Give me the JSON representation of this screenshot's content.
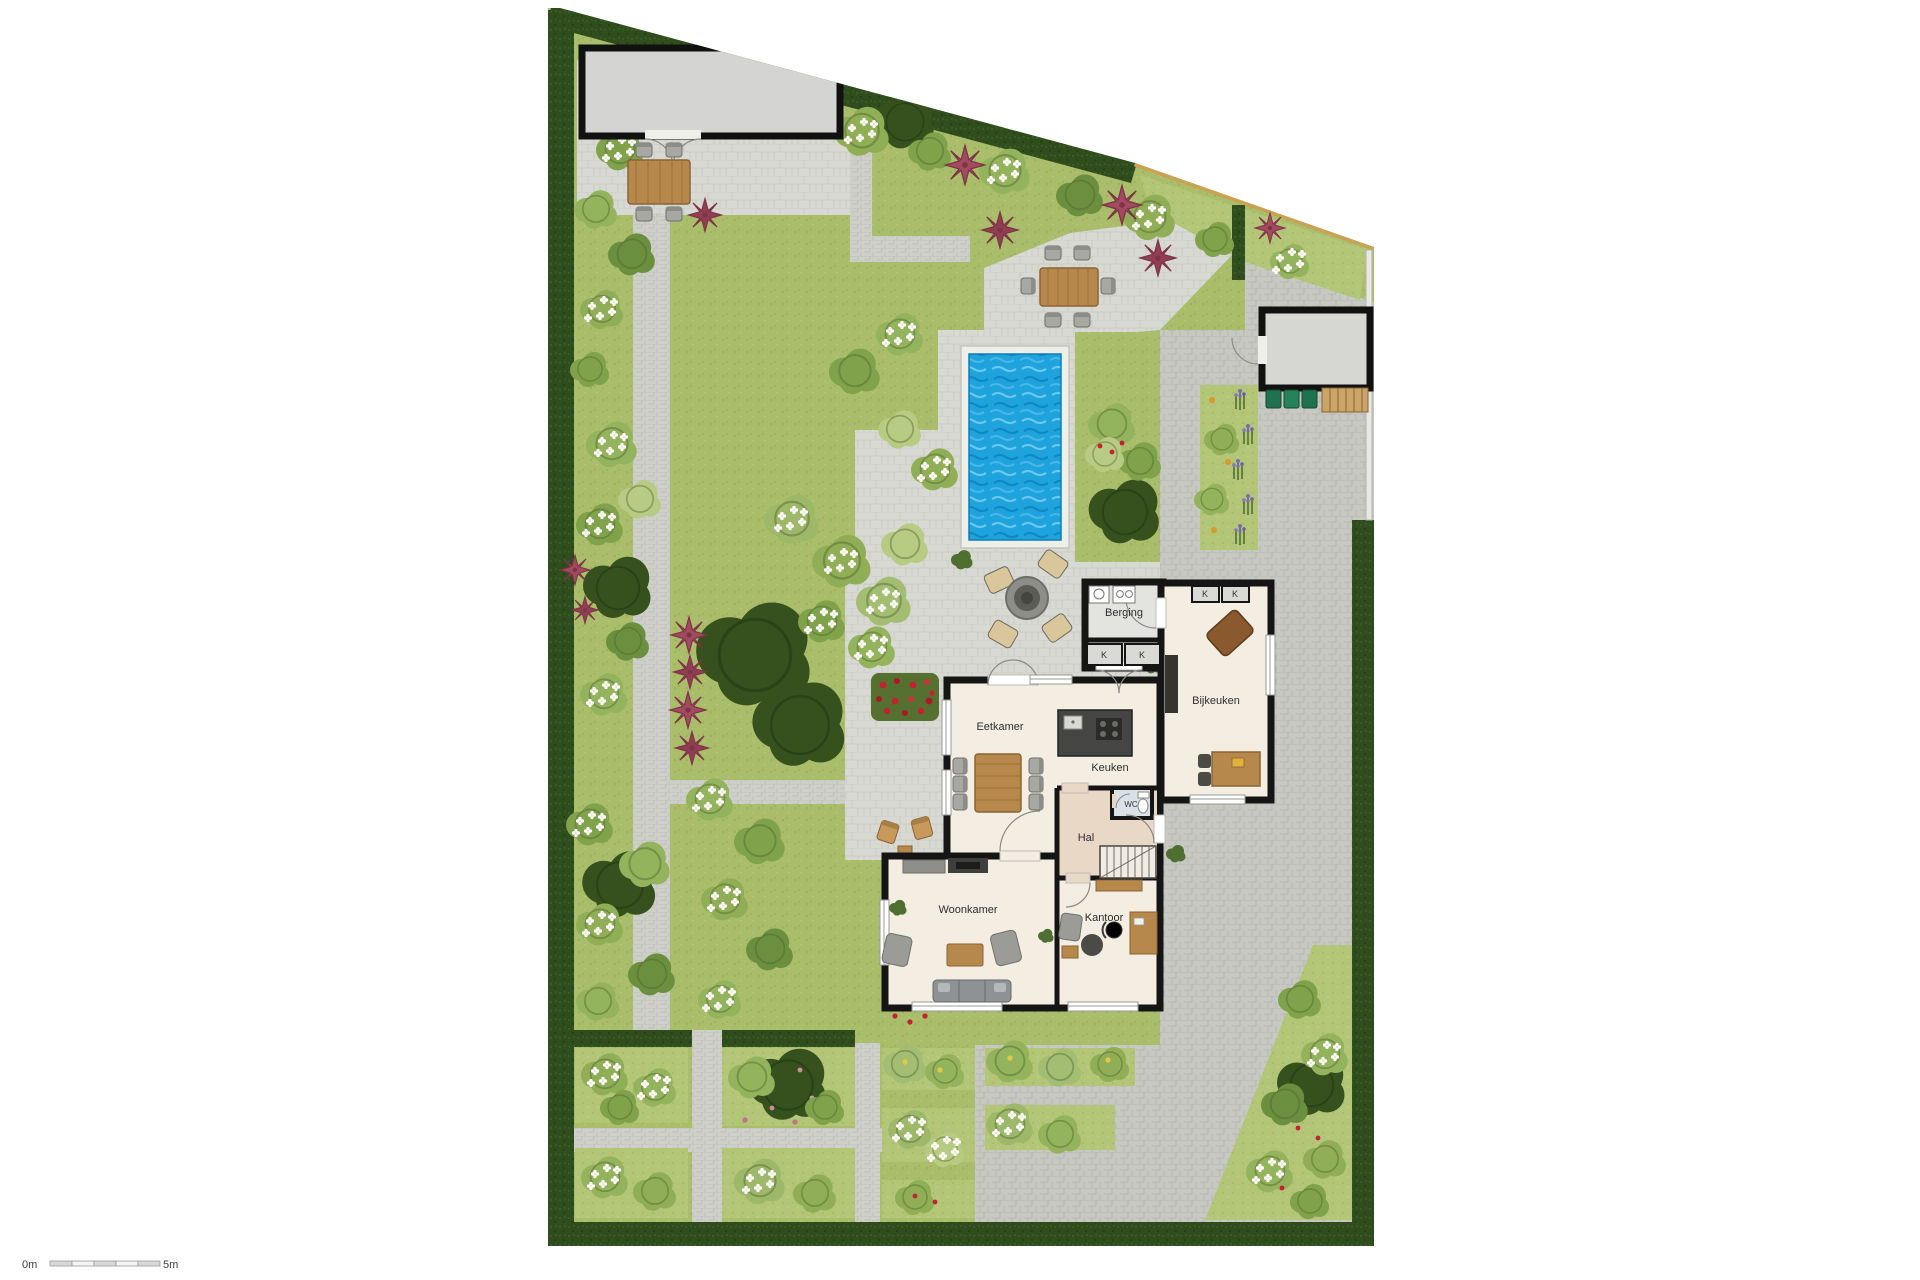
{
  "plan_type": "garden-and-ground-floor-plan",
  "rooms": {
    "eetkamer": "Eetkamer",
    "keuken": "Keuken",
    "woonkamer": "Woonkamer",
    "kantoor": "Kantoor",
    "hal": "Hal",
    "wc": "WC",
    "berging": "Berging",
    "bijkeuken": "Bijkeuken"
  },
  "labels": {
    "closet": "K"
  },
  "scale_bar": {
    "start": "0m",
    "end": "5m"
  },
  "colors": {
    "lawn": "#a9bd6a",
    "hedge": "#2f4d1d",
    "paving": "#d9d9d4",
    "driveway": "#c8c8c3",
    "pool_water": "#1fa3dd",
    "wall": "#151515",
    "floor": "#f3eee1",
    "hall_floor": "#ead8c7",
    "wood": "#b6884c",
    "fence": "#c9a254",
    "accent_plant": "#a24a60",
    "shed": "#d4d4d2"
  }
}
